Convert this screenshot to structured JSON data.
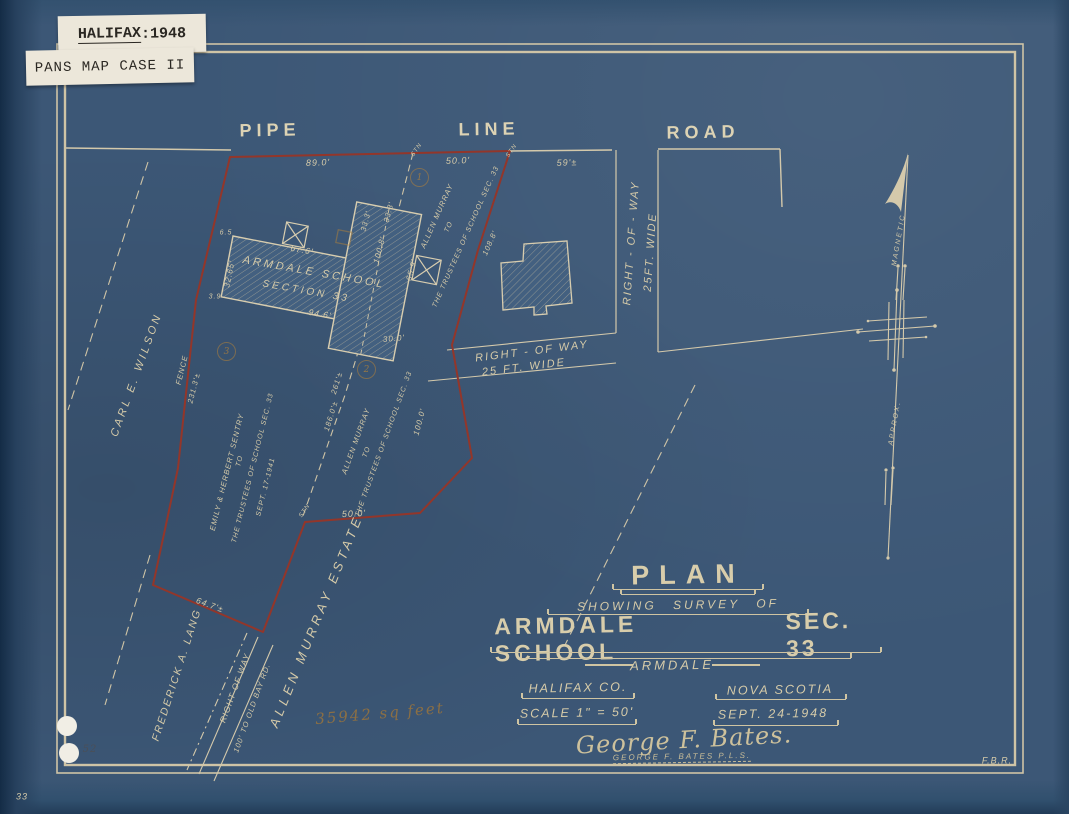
{
  "stickers": {
    "halifax_word": "HALIFAX",
    "halifax_year": ":1948",
    "pans": "PANS MAP CASE II"
  },
  "road": {
    "pipe": "PIPE",
    "line": "LINE",
    "road": "ROAD"
  },
  "dims": {
    "top_89": "89.0'",
    "top_50": "50.0'",
    "top_59": "59'±",
    "stn_a": "STN",
    "stn_b": "STN",
    "stn_c": "STN",
    "school_left": "32.65'",
    "off_top": "6.5",
    "off_bot": "3.9",
    "front": "67.6'",
    "back": "94.6'",
    "wing_33a": "33.3'",
    "wing_33b": "33.3'",
    "wing_100": "100.8'",
    "wing_65": "65.9'",
    "east_108": "108.8'",
    "east_100": "100.0'",
    "mid_30": "30.0'",
    "bottom_50": "50.0'",
    "bottom_64": "64.7'±",
    "div_186": "186.0'±",
    "div_261": "261'±",
    "fence": "FENCE",
    "fence_231": "231.3'±"
  },
  "school": {
    "name": "ARMDALE SCHOOL",
    "section": "SECTION 33"
  },
  "rights_of_way": {
    "east_1": "RIGHT - OF - WAY",
    "east_2": "25FT. WIDE",
    "mid_1": "RIGHT - OF WAY",
    "mid_2": "25 FT. WIDE",
    "south_1": "RIGHT OF WAY",
    "south_2": "100' TO OLD BAY RD."
  },
  "owners": {
    "wilson": "CARL E. WILSON",
    "lang": "FREDERICK A. LANG",
    "murray": "ALLEN MURRAY ESTATE"
  },
  "deeds": {
    "north_1": "ALLEN MURRAY",
    "north_2": "TO",
    "north_3": "THE TRUSTEES OF SCHOOL SEC. 33",
    "west_1": "EMILY & HERBERT SENTRY",
    "west_2": "TO",
    "west_3": "THE TRUSTEES OF SCHOOL SEC. 33",
    "west_4": "SEPT. 17-1941",
    "mid_1": "ALLEN MURRAY",
    "mid_2": "TO",
    "mid_3": "THE TRUSTEES OF SCHOOL SEC. 33"
  },
  "north_arrow": {
    "magnetic": "MAGNETIC",
    "approx": "APPROX."
  },
  "title_block": {
    "title": "PLAN",
    "subtitle": "SHOWING SURVEY OF",
    "name": "ARMDALE SCHOOL",
    "sec": "SEC. 33",
    "place": "ARMDALE",
    "county": "HALIFAX CO.",
    "province": "NOVA SCOTIA",
    "scale": "SCALE 1\" = 50'",
    "date": "SEPT. 24-1948",
    "signature": "George F. Bates.",
    "signature_printed": "GEORGE F. BATES P.L.S."
  },
  "annotations": {
    "sq_feet": "35942 sq feet",
    "pencil_1": "1",
    "pencil_2": "2",
    "pencil_3": "3",
    "punch_note": "52"
  },
  "corners": {
    "drafter": "F.B.R.",
    "page": "33"
  },
  "colors": {
    "paper": "#3c5776",
    "line": "#d6cba9",
    "boundary_red": "#93362a",
    "sticker": "#ece7da",
    "pencil_orange": "#a97f3f"
  }
}
